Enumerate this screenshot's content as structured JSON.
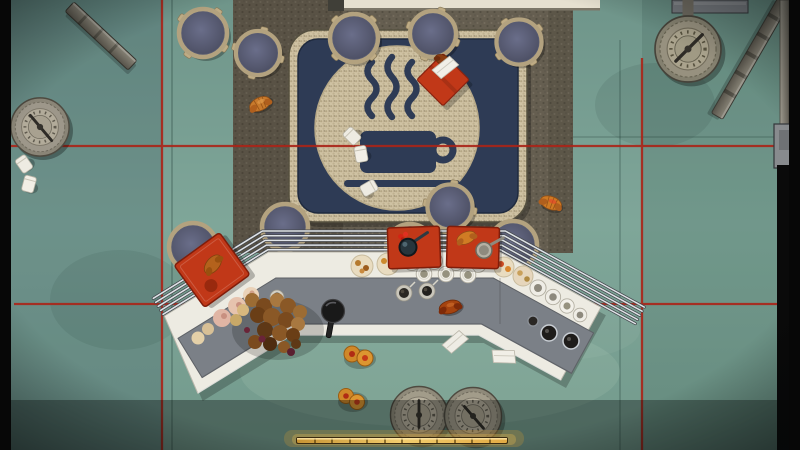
{
  "scene": {
    "description": "Top-down view of a coffee shop: mosaic coffee-cup rug, round cafe tables, chevron buffet counter with pastries and cups, scattered litter, red laser lines, pressure gauges",
    "text_visible": false
  },
  "colors": {
    "laser_red": "#ab2418",
    "tray_red": "#c13818",
    "rug_navy": "#2e3b55",
    "counter_gray": "#7b8087",
    "carpet_brown": "#655e50",
    "gold": "#e9b64d",
    "table_top": "#585c72",
    "letterbox": "#070707"
  },
  "hud": {
    "progress_bar": {
      "value_ratio": 0.98,
      "segments": 12
    }
  },
  "objects": {
    "tables": 10,
    "gauges": 5,
    "red_trays": 3,
    "red_napkin": 1,
    "croissants": 6,
    "paper_cups": 5,
    "paper_scraps": 3,
    "pastry_piles": 1,
    "orange_pastries": 2,
    "coffee_cups_on_counter": 7,
    "white_mugs_in_case": 11,
    "benches": 2
  }
}
